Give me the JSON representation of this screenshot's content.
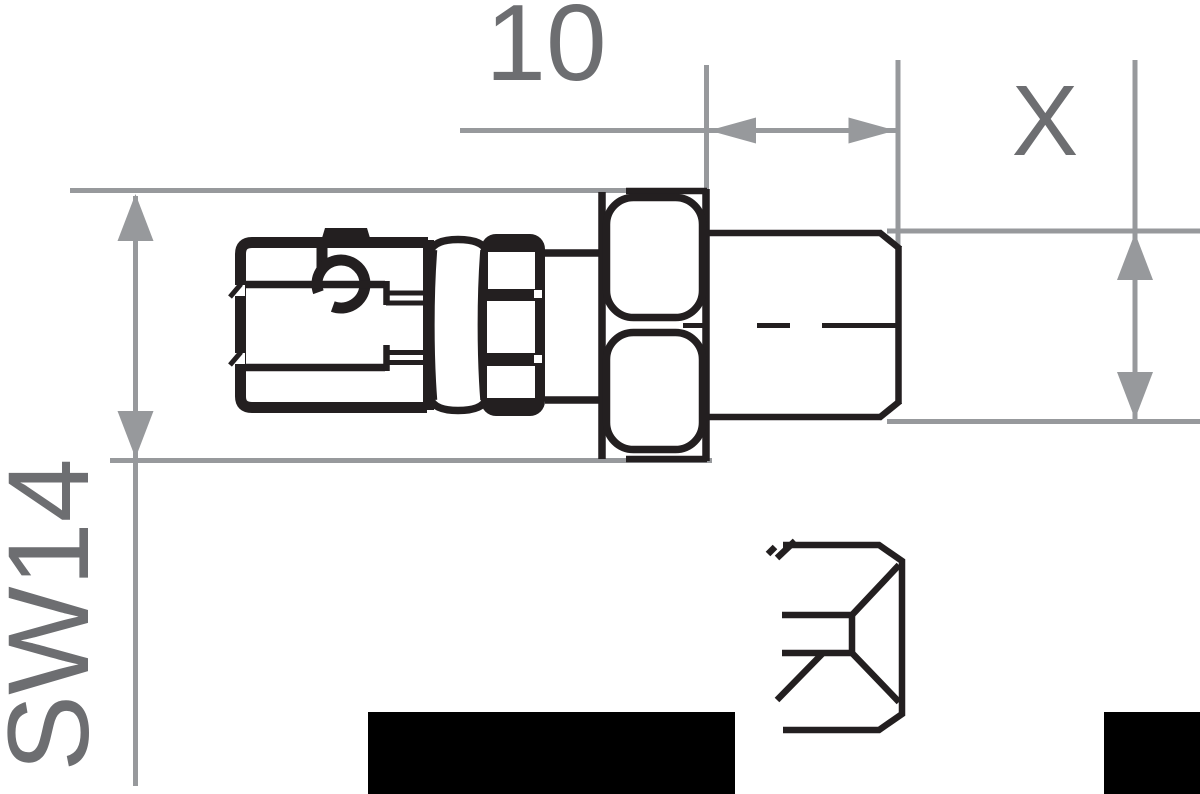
{
  "drawing": {
    "type": "technical-dimension-drawing",
    "views": {
      "side_view": "threaded quick-connect coupling with knurled sleeve and hex nut",
      "end_view": "partial hex end view with square socket"
    },
    "dimensions": {
      "thread_length": {
        "label": "10",
        "measures": "thread length, top horizontal dimension"
      },
      "hex_width": {
        "label": "SW14",
        "measures": "hex nut width across flats, left vertical dimension"
      },
      "thread_diameter": {
        "label": "X",
        "measures": "thread outer diameter, right vertical dimension"
      }
    },
    "colors": {
      "ink": "#231f20",
      "dimline": "#97999c",
      "dimtext": "#6d6e71",
      "paper": "#ffffff",
      "mask": "#000000"
    }
  }
}
